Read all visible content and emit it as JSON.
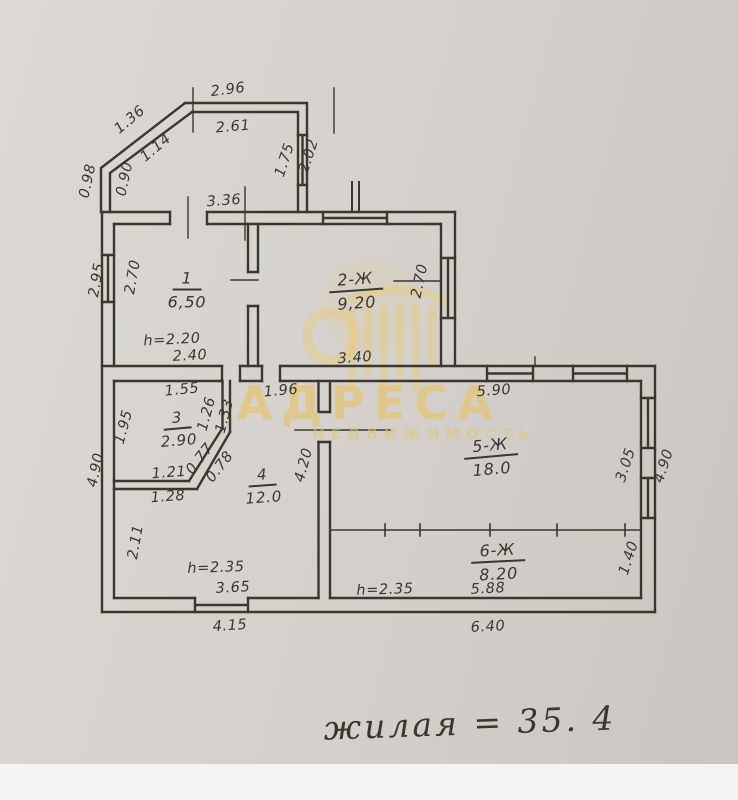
{
  "scan": {
    "watermark": {
      "brand": "АДРЕСА",
      "subtitle": "НЕДВИЖИМОСТЬ"
    },
    "note": {
      "text": "жилая = 35. 4"
    },
    "colors": {
      "paper": "#d5d2cd",
      "ink": "#3b372f",
      "watermark": "#e7cb82"
    }
  },
  "rooms": {
    "r1": {
      "num": "1",
      "area": "6,50"
    },
    "r2": {
      "num": "2-Ж",
      "area": "9,20"
    },
    "r3": {
      "num": "3",
      "area": "2.90"
    },
    "r4": {
      "num": "4",
      "area": "12.0"
    },
    "r5": {
      "num": "5-Ж",
      "area": "18.0"
    },
    "r6": {
      "num": "6-Ж",
      "area": "8.20"
    }
  },
  "dims": {
    "porch_top_outer": "2.96",
    "porch_top_inner": "2.61",
    "porch_bevel_outer": "1.36",
    "porch_bevel_inner": "1.14",
    "porch_left_outer": "0.98",
    "porch_left_inner": "0.90",
    "porch_right_inner": "1.75",
    "porch_right_outer": "2.02",
    "porch_bottom": "3.36",
    "room1_left_outer": "2.95",
    "room1_left_inner": "2.70",
    "room1_height": "h=2.20",
    "room1_bottom": "2.40",
    "room2_right": "2.70",
    "room2_bottom": "3.40",
    "room3_top": "1.55",
    "room3_left": "1.95",
    "room3_right_inner": "1.26",
    "room3_right_outer": "1.33",
    "room3_bevel_inner": "0.77",
    "room3_bevel_outer": "0.78",
    "room3_bottom_inner": "1.21",
    "room3_bottom_outer": "1.28",
    "hall_top": "1.96",
    "room4_right": "4.20",
    "room4_left": "2.11",
    "room4_height": "h=2.35",
    "room4_bottom_inner": "3.65",
    "room4_bottom_outer": "4.15",
    "room5_top": "5.90",
    "room5_right": "3.05",
    "right_side_outer": "4.90",
    "room6_right": "1.40",
    "left_side_outer": "4.90",
    "room6_height": "h=2.35",
    "room6_bottom_inner": "5.88",
    "room6_bottom_outer": "6.40"
  }
}
